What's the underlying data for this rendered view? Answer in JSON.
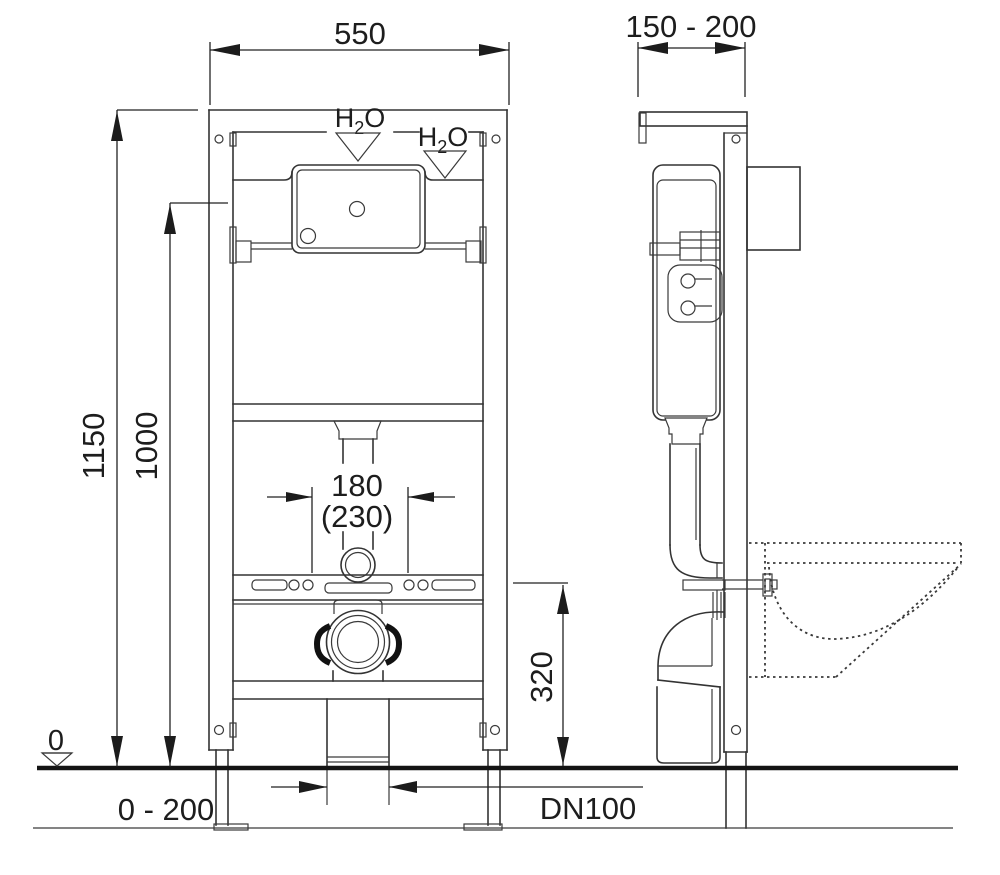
{
  "meta": {
    "type": "technical-installation-drawing",
    "subject": "Wall-hung WC concealed cistern mounting frame - front and side elevations"
  },
  "colors": {
    "line": "#333333",
    "dimension": "#222222",
    "ground": "#141414",
    "background": "#ffffff"
  },
  "dims": {
    "frame_width": "550",
    "frame_depth": "150 - 200",
    "height_total": "1150",
    "height_frame": "1000",
    "flush_offset": "180",
    "flush_offset_alt": "(230)",
    "outlet_height": "320",
    "datum_zero": "0",
    "floor_buildup": "0 - 200",
    "drain_size": "DN100"
  },
  "labels": {
    "water_h": "H",
    "water_sub": "2",
    "water_o": "O"
  }
}
